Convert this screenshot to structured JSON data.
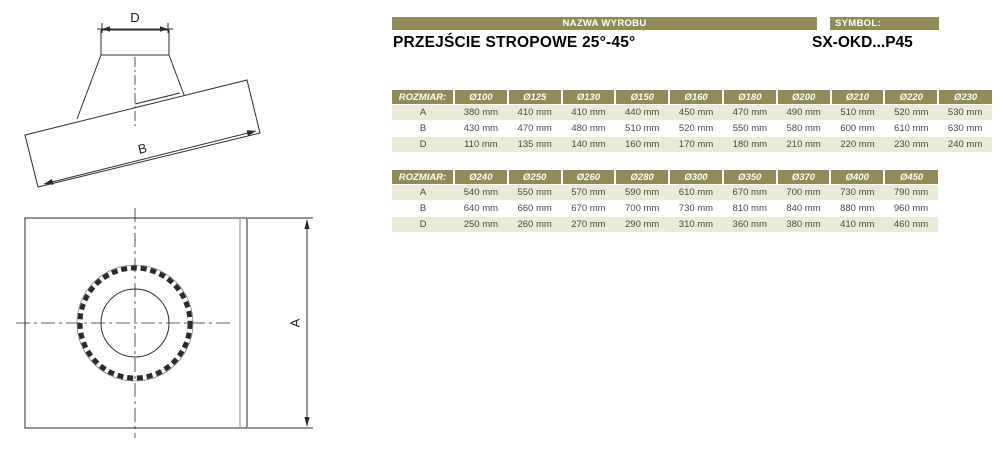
{
  "header": {
    "name_label": "NAZWA WYROBU",
    "symbol_label": "SYMBOL:",
    "product_name": "PRZEJŚCIE STROPOWE 25°-45°",
    "symbol_value": "SX-OKD...P45"
  },
  "colors": {
    "olive_header": "#918c57",
    "row_beige": "#ece9d8",
    "cell_text": "#4a4a41"
  },
  "drawing_labels": {
    "top_diameter": "D",
    "plate_length": "B",
    "plate_side": "A"
  },
  "tables": [
    {
      "size_label": "ROZMIAR:",
      "columns": [
        "Ø100",
        "Ø125",
        "Ø130",
        "Ø150",
        "Ø160",
        "Ø180",
        "Ø200",
        "Ø210",
        "Ø220",
        "Ø230"
      ],
      "rows": [
        {
          "label": "A",
          "values": [
            "380 mm",
            "410 mm",
            "410 mm",
            "440 mm",
            "450 mm",
            "470 mm",
            "490 mm",
            "510 mm",
            "520 mm",
            "530 mm"
          ]
        },
        {
          "label": "B",
          "values": [
            "430 mm",
            "470 mm",
            "480 mm",
            "510 mm",
            "520 mm",
            "550 mm",
            "580 mm",
            "600 mm",
            "610 mm",
            "630 mm"
          ]
        },
        {
          "label": "D",
          "values": [
            "110 mm",
            "135 mm",
            "140 mm",
            "160 mm",
            "170 mm",
            "180 mm",
            "210 mm",
            "220 mm",
            "230 mm",
            "240 mm"
          ]
        }
      ]
    },
    {
      "size_label": "ROZMIAR:",
      "columns": [
        "Ø240",
        "Ø250",
        "Ø260",
        "Ø280",
        "Ø300",
        "Ø350",
        "Ø370",
        "Ø400",
        "Ø450"
      ],
      "rows": [
        {
          "label": "A",
          "values": [
            "540 mm",
            "550 mm",
            "570 mm",
            "590 mm",
            "610 mm",
            "670 mm",
            "700 mm",
            "730 mm",
            "790 mm"
          ]
        },
        {
          "label": "B",
          "values": [
            "640 mm",
            "660 mm",
            "670 mm",
            "700 mm",
            "730 mm",
            "810 mm",
            "840 mm",
            "880 mm",
            "960 mm"
          ]
        },
        {
          "label": "D",
          "values": [
            "250 mm",
            "260 mm",
            "270 mm",
            "290 mm",
            "310 mm",
            "360 mm",
            "380 mm",
            "410 mm",
            "460 mm"
          ]
        }
      ]
    }
  ]
}
